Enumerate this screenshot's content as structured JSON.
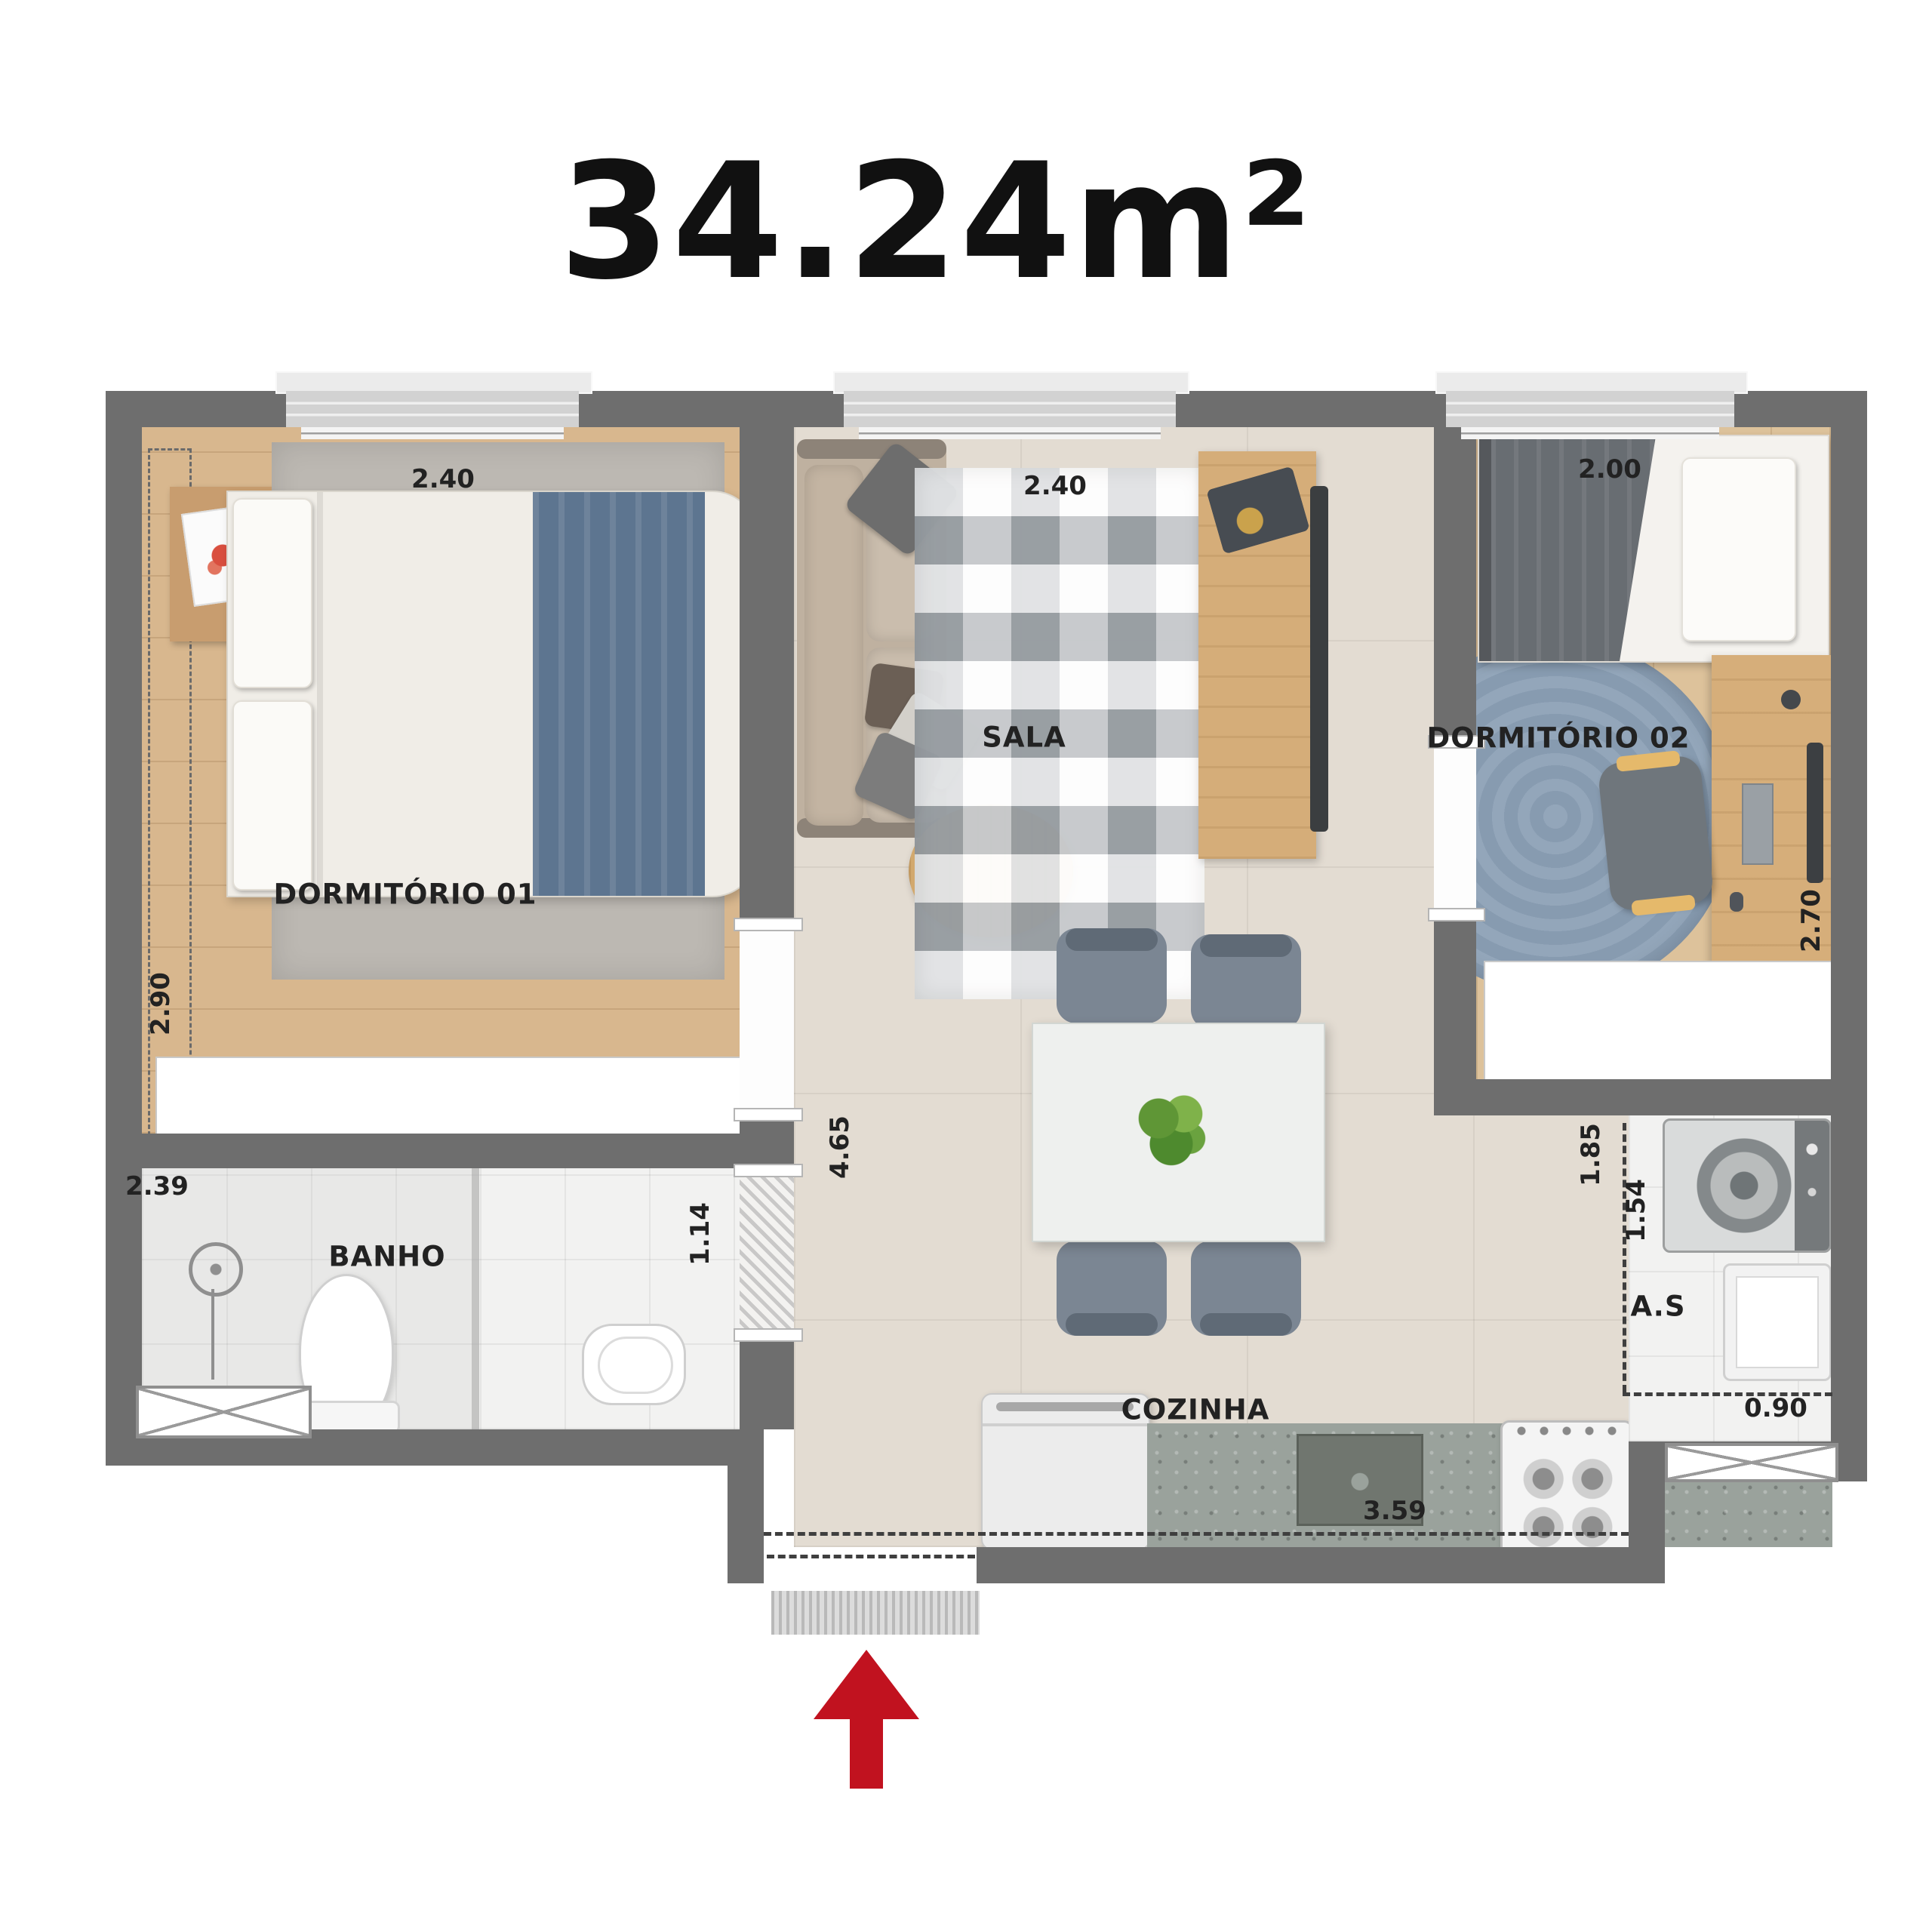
{
  "title": "34.24m²",
  "rooms": {
    "dorm01": {
      "label": "DORMITÓRIO 01",
      "width": "2.40",
      "height": "2.90"
    },
    "sala": {
      "label": "SALA",
      "width": "2.40"
    },
    "dorm02": {
      "label": "DORMITÓRIO 02",
      "width": "2.00",
      "height": "2.70"
    },
    "banho": {
      "label": "BANHO",
      "width": "2.39"
    },
    "cozinha": {
      "label": "COZINHA",
      "width": "3.59"
    },
    "servico": {
      "label": "A.S",
      "width": "1.85",
      "height": "1.54"
    }
  },
  "dims": {
    "hall_passage": "1.14",
    "living_depth": "4.65",
    "entry_width": "0.90"
  },
  "colors": {
    "wall": "#6e6e6e",
    "accent_red": "#c1121f",
    "floor_wood": "#d8b78e",
    "floor_tile": "#e3dcd2",
    "blanket_blue": "#5d7590",
    "rug_blue": "#92a5b9"
  }
}
